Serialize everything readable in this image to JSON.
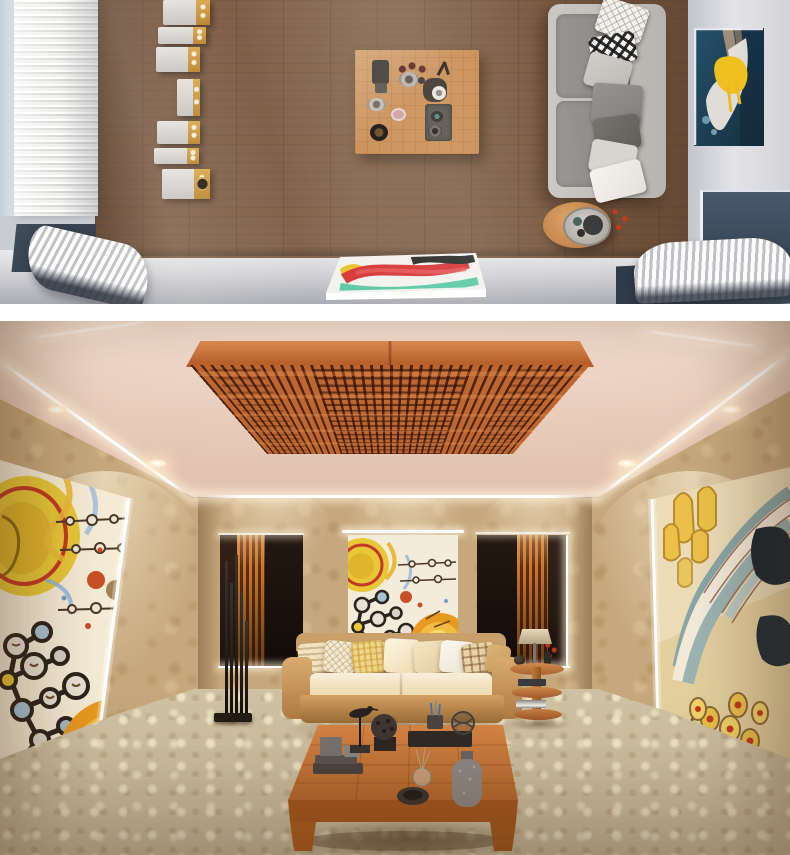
{
  "page": {
    "title": "Hi-fi listening room — two interior renders",
    "background": "#ffffff",
    "divider": "#ffffff"
  },
  "renders": {
    "top": {
      "label": "Top-down render: listening room with ribbed acoustic wall, speaker cabinet line-up, wood plank floor, coffee table with tableware, grey sofa with patterned pillows, round side table and abstract art",
      "objects": [
        "ribbed-acoustic-panel",
        "speaker-array-7-cabinets",
        "wood-plank-floor",
        "coffee-table-with-decor",
        "grey-sofa-with-pillows",
        "round-side-table-tray",
        "abstract-painting-teal-yellow",
        "curved-bass-trap-diffusers",
        "painted-canvas"
      ]
    },
    "bottom": {
      "label": "Perspective render: listening lounge with wooden ceiling diffuser, LED cove lighting, damask wallpaper, abstract murals, cream sofa, rod floor lamp, tiered side table and low wooden coffee table on patterned carpet",
      "objects": [
        "wood-ceiling-diffuser",
        "led-cove-lighting",
        "recessed-downlights",
        "damask-wallpaper",
        "left-wall-mural",
        "right-wall-mural",
        "wall-tapestry",
        "slatted-niche-panels",
        "rod-floor-lamp",
        "cream-sofa-with-pillows",
        "three-tier-side-table",
        "low-wood-coffee-table",
        "patterned-beige-carpet"
      ]
    }
  },
  "palette": {
    "wood_floor": "#7b5a42",
    "speaker_gold": "#cc9c44",
    "sofa_grey": "#8e8b88",
    "sofa_frame_grey": "#c6c2be",
    "art_navy": "#1d4254",
    "art_yellow": "#f0c01f",
    "right_wall_grey": "#d9dadd",
    "ceiling_pink": "#eed6c6",
    "diffuser_orange": "#bd6630",
    "diffuser_shadow": "#5e2c10",
    "wallpaper_beige": "#c6a87c",
    "niche_dark": "#241811",
    "slat_orange": "#c9782e",
    "sofa_cream": "#f0dfb9",
    "sofa_tan": "#c38d55",
    "carpet_beige": "#cfc2a2",
    "table_wood": "#c98f57",
    "decor_charcoal": "#46403b",
    "led_white": "#ffffff"
  }
}
